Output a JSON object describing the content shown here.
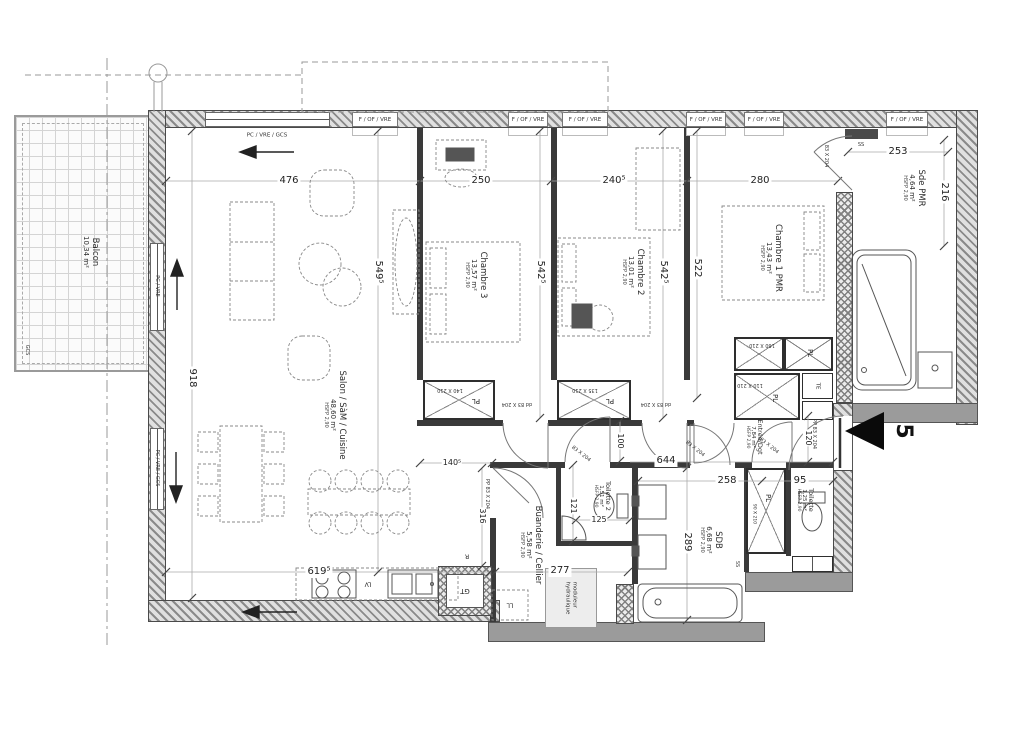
{
  "unit": {
    "number": "5"
  },
  "rooms": {
    "balcon": {
      "name": "Balcon",
      "area": "10,34 m²"
    },
    "salon": {
      "name": "Salon / SàM / Cuisine",
      "area": "48,60 m²",
      "hsfp": "HSFP 2,90"
    },
    "chambre3": {
      "name": "Chambre 3",
      "area": "13,57 m²",
      "hsfp": "HSFP 2,90"
    },
    "chambre2": {
      "name": "Chambre 2",
      "area": "13,01 m²",
      "hsfp": "HSFP 2,90"
    },
    "chambre1": {
      "name": "Chambre 1 PMR",
      "area": "13,43 m²",
      "hsfp": "HSFP 2,90"
    },
    "sde_pmr": {
      "name": "Sde PMR",
      "area": "4,64 m²",
      "hsfp": "HSFP 2,90"
    },
    "entree": {
      "name": "Entrée/Dgt",
      "area": "7,84 m²",
      "hsfp": "HSFP 2,90"
    },
    "toilette2": {
      "name": "Toilette 2",
      "area": "1,51 m²",
      "hsfp": "HSFP 2,90"
    },
    "toilette": {
      "name": "Toilette",
      "area": "1,25 m²",
      "hsfp": "HSFP 2,90"
    },
    "sdb": {
      "name": "SDB",
      "area": "6,68 m²",
      "hsfp": "HSFP 2,90"
    },
    "buanderie": {
      "name": "Buanderie / Cellier",
      "area": "5,58 m²",
      "hsfp": "HSFP 2,90"
    }
  },
  "openings": {
    "f_of_vre": "F / OF / VRE",
    "pc_vre_gcs": "PC / VRE / GCS",
    "pc_vre": "PC / VRE"
  },
  "dims": {
    "top_salon": "476",
    "top_ch3": "250",
    "top_ch2": "240⁵",
    "top_ch1": "280",
    "sde_w": "253",
    "sde_h": "216",
    "salon_h": "549⁵",
    "ch3_h": "542⁵",
    "ch2_h": "542⁵",
    "ch1_h": "522",
    "left_h": "918",
    "salon_w_bottom": "619⁵",
    "hall_w": "140⁵",
    "hall_h_left": "316",
    "hall_h": "100",
    "entree_w": "644",
    "entree_w2": "258",
    "toilette_w": "95",
    "entree_h": "120",
    "toilette2_h": "121",
    "toilette2_w": "125",
    "buanderie_w": "277",
    "sdb_h": "289"
  },
  "tags": {
    "pl": "PL",
    "te": "TE",
    "gt": "GT",
    "ll": "LL",
    "lv": "LV",
    "r": "R",
    "ss": "SS",
    "dd": "dd",
    "pp": "PP",
    "gcs": "GCS",
    "door": "83 X 204",
    "closet140": "140 X 210",
    "closet135": "135 X 210",
    "closet160": "160 X 210",
    "closet110": "110 X 210",
    "closet90": "90 X 210",
    "module1": "moduleur",
    "module2": "hydraulique"
  }
}
